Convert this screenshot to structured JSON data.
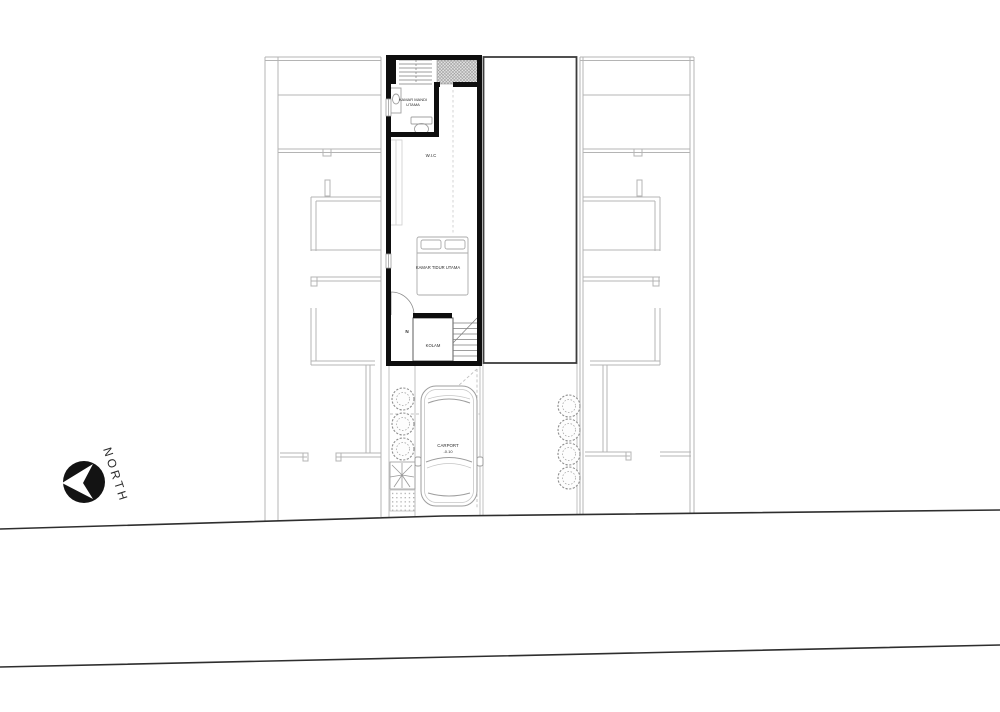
{
  "compass": {
    "label": "NORTH"
  },
  "plan": {
    "rooms": {
      "master_bathroom": {
        "label_line1": "KAMAR MANDI",
        "label_line2": "UTAMA"
      },
      "walk_in_closet": {
        "label": "W.I.C"
      },
      "master_bedroom": {
        "label": "KAMAR TIDUR UTAMA"
      },
      "pond": {
        "label": "KOLAM"
      },
      "stair": {
        "marker": "N"
      }
    },
    "carport": {
      "label": "CARPORT",
      "level": "-0.10"
    }
  },
  "colors": {
    "unit_wall": "#0e0e0e",
    "neighbor_line": "#b4b4b4",
    "road_line": "#2e2e2e",
    "fixture_line": "#a0a0a0",
    "block_border": "#3d3d3d",
    "compass_fill": "#131313"
  }
}
